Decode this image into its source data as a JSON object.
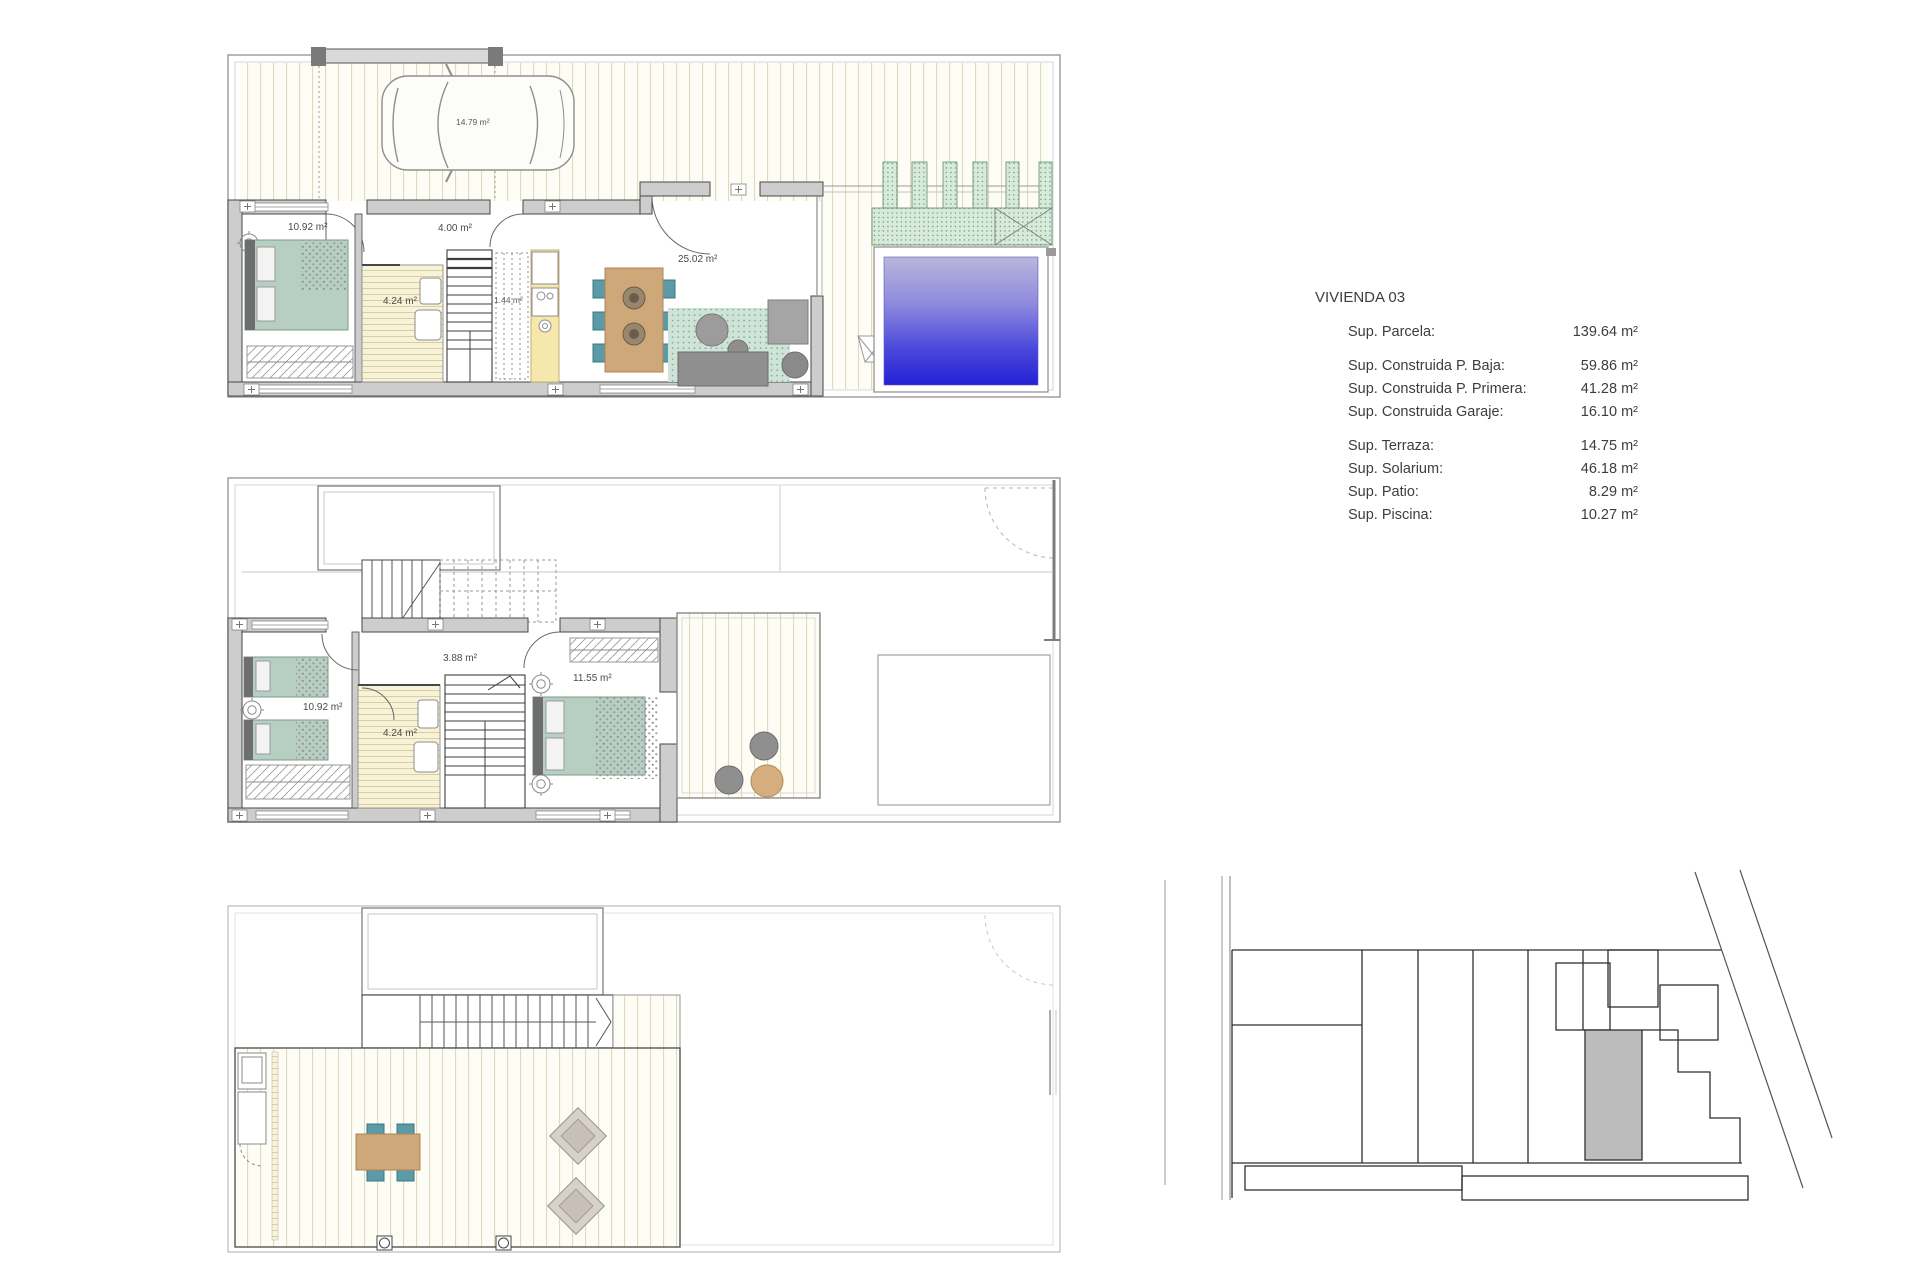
{
  "info_panel": {
    "title": "VIVIENDA 03",
    "rows": [
      {
        "label": "Sup. Parcela:",
        "value": "139.64 m²"
      },
      {
        "label": "Sup. Construida P. Baja:",
        "value": "59.86 m²"
      },
      {
        "label": "Sup. Construida P. Primera:",
        "value": "41.28 m²"
      },
      {
        "label": "Sup. Construida Garaje:",
        "value": "16.10 m²"
      },
      {
        "label": "Sup. Terraza:",
        "value": "14.75 m²"
      },
      {
        "label": "Sup. Solarium:",
        "value": "46.18 m²"
      },
      {
        "label": "Sup. Patio:",
        "value": "8.29 m²"
      },
      {
        "label": "Sup. Piscina:",
        "value": "10.27 m²"
      }
    ]
  },
  "ground_floor_plan": {
    "labels": {
      "garage_area": "14.79 m²",
      "bedroom_area": "10.92 m²",
      "hall_area": "4.00 m²",
      "bathroom_area": "4.24 m²",
      "closet_area": "1.44 m²",
      "living_area": "25.02 m²"
    }
  },
  "first_floor_plan": {
    "labels": {
      "bedroom1_area": "10.92 m²",
      "hall_area": "3.88 m²",
      "bathroom_area": "4.24 m²",
      "bedroom2_area": "11.55 m²"
    }
  },
  "colors": {
    "pool_top": "#bab6dc",
    "pool_bottom": "#2321d6",
    "bed_green": "#b7cfc2",
    "chair_teal": "#5b9aa6",
    "wood_tan": "#cfa87a",
    "plant_green": "#d7ead9",
    "wall_gray": "#cdcdcd",
    "highlight_plot_gray": "#bcbcbc"
  }
}
